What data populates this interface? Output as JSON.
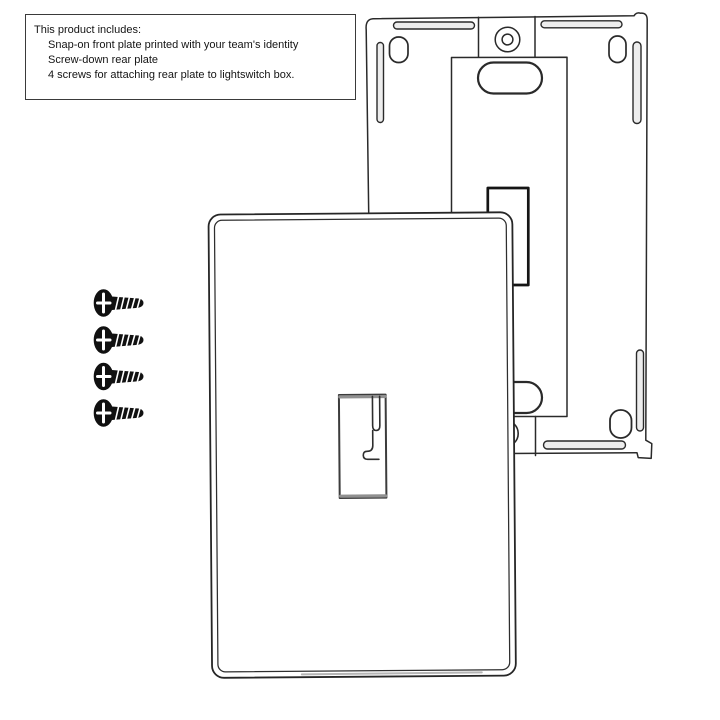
{
  "info_box": {
    "title": "This product includes:",
    "items": [
      "Snap-on front plate printed with your team's identity",
      "Screw-down rear plate",
      "4 screws for attaching rear plate to lightswitch box."
    ]
  },
  "screws": {
    "count": 4
  },
  "colors": {
    "background": "#ffffff",
    "line": "#2a2a2a",
    "dark_line": "#151515",
    "screw_black": "#111111",
    "slot_fill": "#ededed",
    "toggle_edge_gray": "#909090"
  }
}
